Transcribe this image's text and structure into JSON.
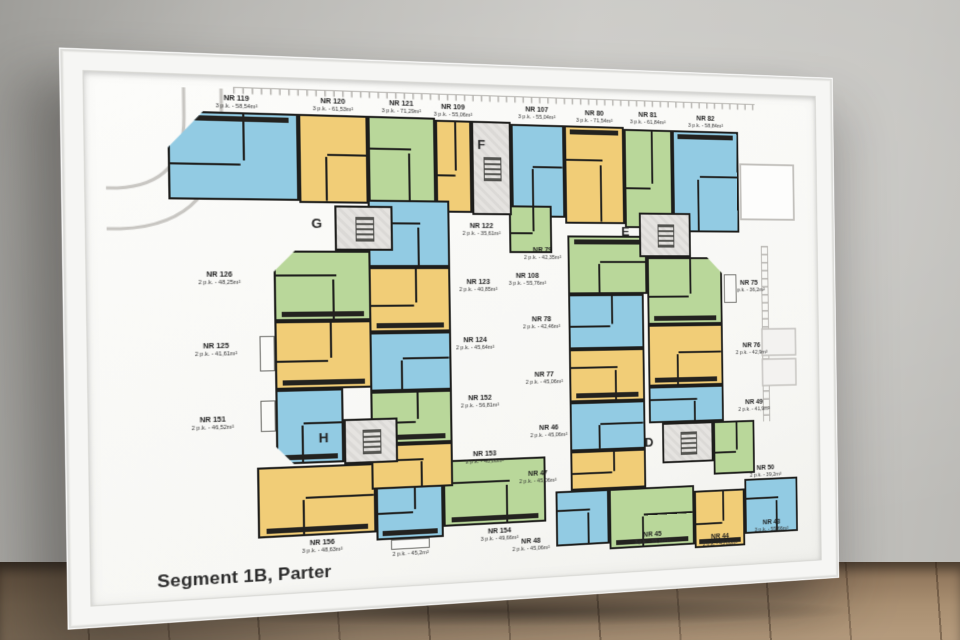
{
  "poster": {
    "title": "Segment 1B, Parter"
  },
  "palette": {
    "unit_blue": "#92cbe3",
    "unit_yellow": "#f1cd77",
    "unit_green": "#b9d79a",
    "walls": "#1d1d1b",
    "core_fill": "#e5e3e0",
    "paper": "#fbfbf8",
    "frame": "#f6f6f4"
  },
  "cores": [
    {
      "id": "F",
      "letter": "F"
    },
    {
      "id": "G",
      "letter": "G"
    },
    {
      "id": "H",
      "letter": "H"
    },
    {
      "id": "E",
      "letter": "E"
    },
    {
      "id": "D",
      "letter": "D"
    }
  ],
  "apartments": [
    {
      "id": "119",
      "nr": "NR 119",
      "info": "3 p.k. - 58,54m²",
      "color": "blue"
    },
    {
      "id": "120",
      "nr": "NR 120",
      "info": "3 p.k. - 61,53m²",
      "color": "yellow"
    },
    {
      "id": "121",
      "nr": "NR 121",
      "info": "3 p.k. - 71,29m²",
      "color": "green"
    },
    {
      "id": "109",
      "nr": "NR 109",
      "info": "3 p.k. - 55,06m²",
      "color": "yellow"
    },
    {
      "id": "107",
      "nr": "NR 107",
      "info": "3 p.k. - 55,04m²",
      "color": "blue"
    },
    {
      "id": "80",
      "nr": "NR 80",
      "info": "3 p.k. - 71,54m²",
      "color": "yellow"
    },
    {
      "id": "81",
      "nr": "NR 81",
      "info": "3 p.k. - 61,84m²",
      "color": "green"
    },
    {
      "id": "82",
      "nr": "NR 82",
      "info": "3 p.k. - 58,84m²",
      "color": "blue"
    },
    {
      "id": "126",
      "nr": "NR 126",
      "info": "2 p.k. - 48,25m²",
      "color": "green"
    },
    {
      "id": "125",
      "nr": "NR 125",
      "info": "2 p.k. - 41,61m²",
      "color": "yellow"
    },
    {
      "id": "151",
      "nr": "NR 151",
      "info": "2 p.k. - 46,52m²",
      "color": "blue"
    },
    {
      "id": "156",
      "nr": "NR 156",
      "info": "3 p.k. - 48,63m²",
      "color": "yellow"
    },
    {
      "id": "155",
      "nr": "NR 155",
      "info": "2 p.k. - 45,2m²",
      "color": "blue"
    },
    {
      "id": "154",
      "nr": "NR 154",
      "info": "3 p.k. - 49,66m²",
      "color": "green"
    },
    {
      "id": "122",
      "nr": "NR 122",
      "info": "2 p.k. - 35,61m²",
      "color": "blue"
    },
    {
      "id": "123",
      "nr": "NR 123",
      "info": "2 p.k. - 40,85m²",
      "color": "yellow"
    },
    {
      "id": "124",
      "nr": "NR 124",
      "info": "2 p.k. - 45,64m²",
      "color": "blue"
    },
    {
      "id": "152",
      "nr": "NR 152",
      "info": "2 p.k. - 56,81m²",
      "color": "green"
    },
    {
      "id": "153",
      "nr": "NR 153",
      "info": "2 p.k. - 48,86m²",
      "color": "yellow"
    },
    {
      "id": "108",
      "nr": "NR 108",
      "info": "3 p.k. - 55,76m²",
      "color": "green"
    },
    {
      "id": "79",
      "nr": "NR 79",
      "info": "2 p.k. - 42,35m²",
      "color": "green"
    },
    {
      "id": "78",
      "nr": "NR 78",
      "info": "2 p.k. - 42,46m²",
      "color": "blue"
    },
    {
      "id": "77",
      "nr": "NR 77",
      "info": "2 p.k. - 45,06m²",
      "color": "yellow"
    },
    {
      "id": "46",
      "nr": "NR 46",
      "info": "2 p.k. - 45,06m²",
      "color": "blue"
    },
    {
      "id": "47",
      "nr": "NR 47",
      "info": "2 p.k. - 45,06m²",
      "color": "yellow"
    },
    {
      "id": "48",
      "nr": "NR 48",
      "info": "2 p.k. - 45,06m²",
      "color": "blue"
    },
    {
      "id": "75",
      "nr": "NR 75",
      "info": "2 p.k. - 36,2m²",
      "color": "green"
    },
    {
      "id": "76",
      "nr": "NR 76",
      "info": "2 p.k. - 42,9m²",
      "color": "yellow"
    },
    {
      "id": "49",
      "nr": "NR 49",
      "info": "2 p.k. - 41,9m²",
      "color": "blue"
    },
    {
      "id": "50",
      "nr": "NR 50",
      "info": "2 p.k. - 39,2m²",
      "color": "green"
    },
    {
      "id": "45",
      "nr": "NR 45",
      "info": "3 p.k. - 55,66m²",
      "color": "green"
    },
    {
      "id": "44",
      "nr": "NR 44",
      "info": "2 p.k. - 45,86m²",
      "color": "yellow"
    },
    {
      "id": "43",
      "nr": "NR 43",
      "info": "3 p.k. - 55,66m²",
      "color": "blue"
    }
  ]
}
